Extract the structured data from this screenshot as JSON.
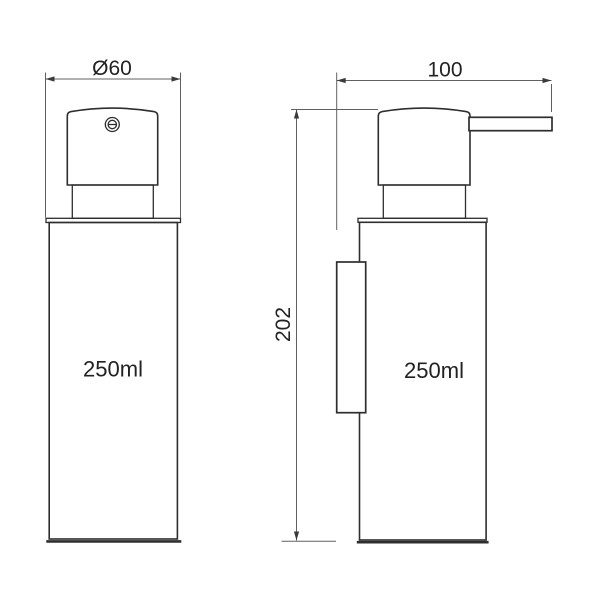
{
  "drawing": {
    "type": "technical-dimension-drawing",
    "subject": "soap-dispenser",
    "background_color": "#ffffff",
    "object_line_color": "#2e2e2e",
    "dimension_line_color": "#606060",
    "front_view": {
      "diameter_dimension_label": "Ø60",
      "capacity_label": "250ml"
    },
    "side_view": {
      "depth_dimension_label": "100",
      "height_dimension_label": "202",
      "capacity_label": "250ml"
    }
  }
}
